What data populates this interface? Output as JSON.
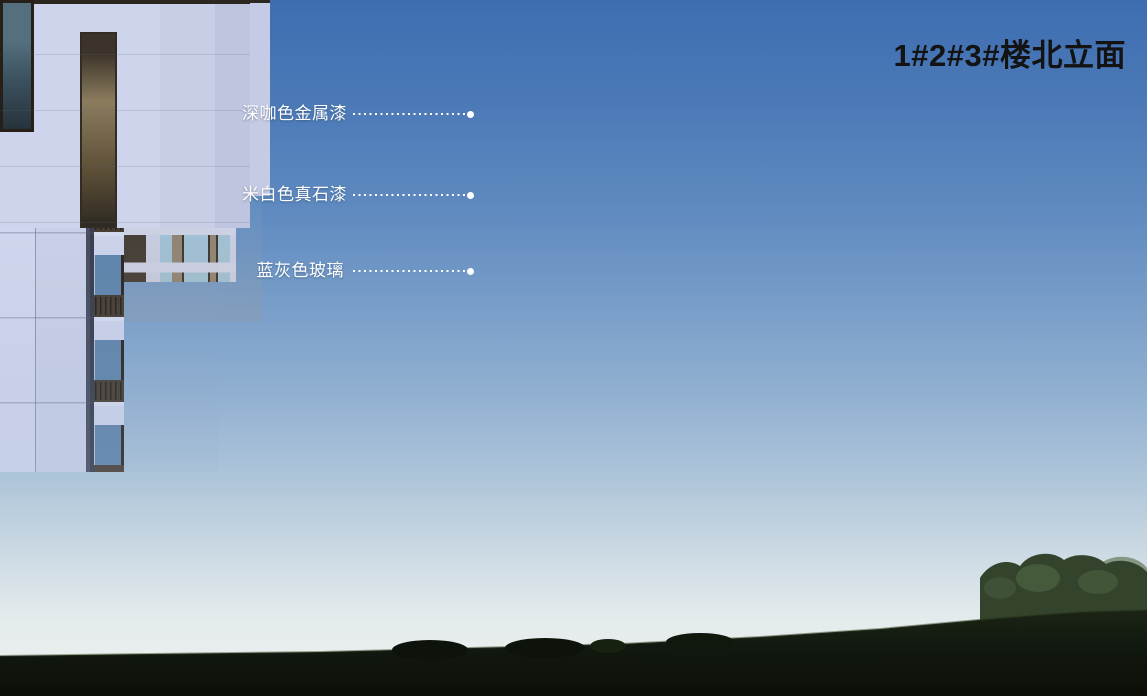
{
  "title": "1#2#3#楼北立面",
  "annotations": [
    {
      "id": "dark-coffee-metallic-paint",
      "label": "深咖色金属漆"
    },
    {
      "id": "off-white-stone-paint",
      "label": "米白色真石漆"
    },
    {
      "id": "blue-gray-glass",
      "label": "蓝灰色玻璃"
    }
  ],
  "palette": {
    "sky_top": "#3e6db1",
    "sky_horizon": "#eff2ef",
    "wall_offwhite_stone": "#cbd1e8",
    "metal_coffee_dark": "#3a322a",
    "glass_blue_gray": "#a6c6da",
    "glass_warm_lit": "#c9a869",
    "lawn_dark_green": "#11170e",
    "tree_green": "#33432c",
    "title_color": "#131313",
    "annotation_color": "#ffffff"
  }
}
